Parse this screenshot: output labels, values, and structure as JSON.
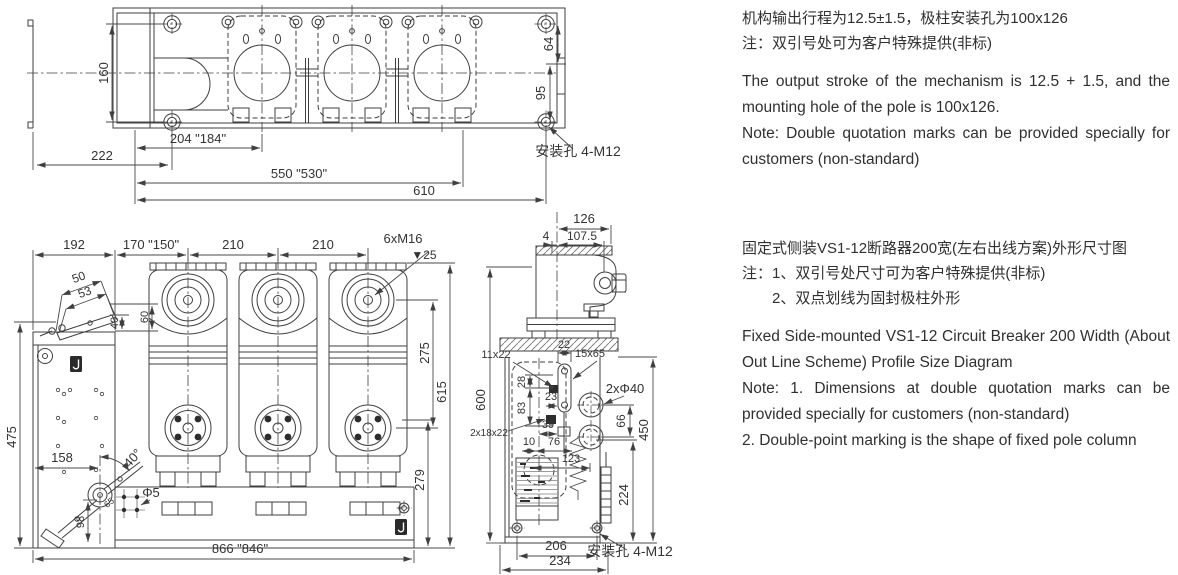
{
  "notes": {
    "top": {
      "cn1": "机构输出行程为12.5±1.5，极柱安装孔为100x126",
      "cn2": "注：双引号处可为客户特殊提供(非标)",
      "en1": "The output stroke of the mechanism is 12.5 + 1.5, and the mounting hole of the pole is 100x126.",
      "en2": "Note: Double quotation marks can be provided specially for customers (non-standard)"
    },
    "mid": {
      "cn1": "固定式侧装VS1-12断路器200宽(左右出线方案)外形尺寸图",
      "cn2": "注：1、双引号处尺寸可为客户特殊提供(非标)",
      "cn3": "2、双点划线为固封极柱外形",
      "en1": "Fixed Side-mounted VS1-12 Circuit Breaker 200 Width (About Out Line Scheme) Profile Size Diagram",
      "en2": "Note: 1. Dimensions at double quotation marks can be provided specially for customers (non-standard)",
      "en3": "2. Double-point marking is the shape of fixed pole column"
    }
  },
  "top_view": {
    "d160": "160",
    "d222": "222",
    "d204": "204 \"184\"",
    "d550": "550 \"530\"",
    "d610": "610",
    "d64": "64",
    "d95": "95",
    "mount_label": "安装孔 4-M12"
  },
  "front_view": {
    "d192": "192",
    "d170": "170 \"150\"",
    "d210a": "210",
    "d210b": "210",
    "bolt_spec": "6xM16",
    "depth": "▼25",
    "d50": "50",
    "d53": "53",
    "d40": "40",
    "d60": "60",
    "d475": "475",
    "d158": "158",
    "d98": "98",
    "d65": "65",
    "angle": "40°",
    "hole": "Φ5",
    "d275": "275",
    "d615": "615",
    "d279": "279",
    "d866": "866 \"846\""
  },
  "side_view": {
    "d126": "126",
    "d107_5": "107.5",
    "d4": "4",
    "d600": "600",
    "d22": "22",
    "slot_a": "11x22",
    "slot_b": "15x65",
    "holes": "2xΦ40",
    "d28": "28",
    "d83": "83",
    "d23": "23",
    "d39": "39",
    "slot_c": "2x18x22",
    "d10": "10",
    "d76": "76",
    "d123": "123",
    "d66": "66",
    "d450": "450",
    "d224": "224",
    "d206": "206",
    "d234": "234",
    "mount_label": "安装孔 4-M12"
  }
}
